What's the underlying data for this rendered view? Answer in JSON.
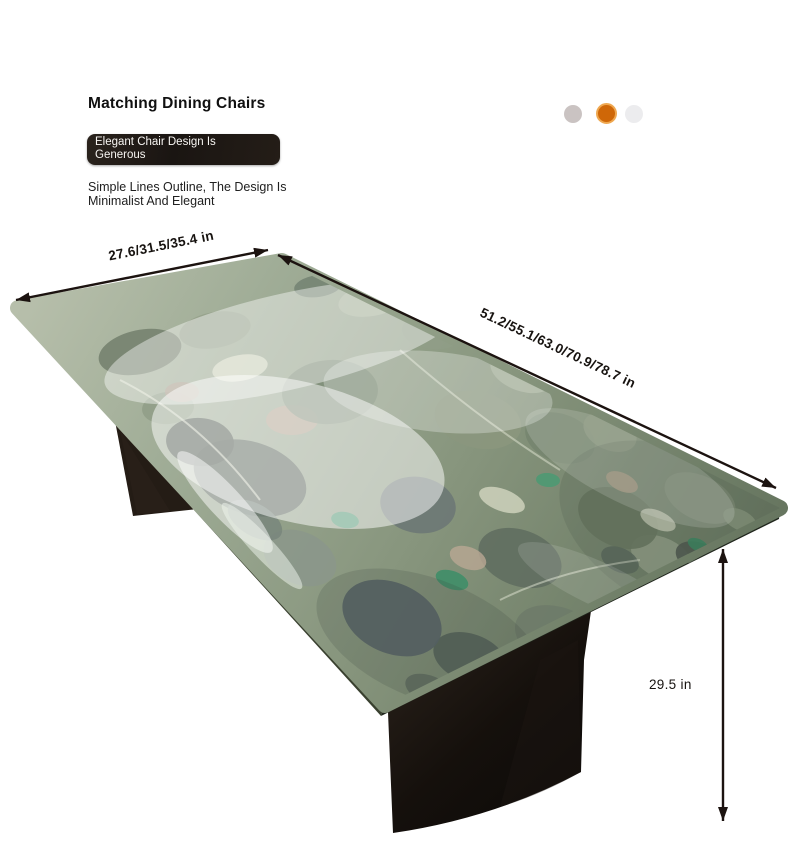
{
  "header": {
    "title": "Matching Dining Chairs",
    "badge_line1": "Elegant Chair Design Is",
    "badge_line2": "Generous",
    "description_line1": "Simple Lines Outline, The Design Is",
    "description_line2": "Minimalist And Elegant"
  },
  "swatches": [
    {
      "name": "warm-gray",
      "color": "#cac3c2",
      "selected": false
    },
    {
      "name": "orange",
      "color": "#cf6708",
      "selected": true
    },
    {
      "name": "light-gray",
      "color": "#ececee",
      "selected": false
    }
  ],
  "dimensions": {
    "width_label": "27.6/31.5/35.4 in",
    "length_label": "51.2/55.1/63.0/70.9/78.7 in",
    "height_label": "29.5 in"
  },
  "style": {
    "annotation_color": "#1c1310",
    "badge_bg_color": "#1e1813",
    "badge_text_color": "#f7f5f2",
    "tabletop_base_color": "#8d9a84",
    "leg_color": "#17120e"
  }
}
